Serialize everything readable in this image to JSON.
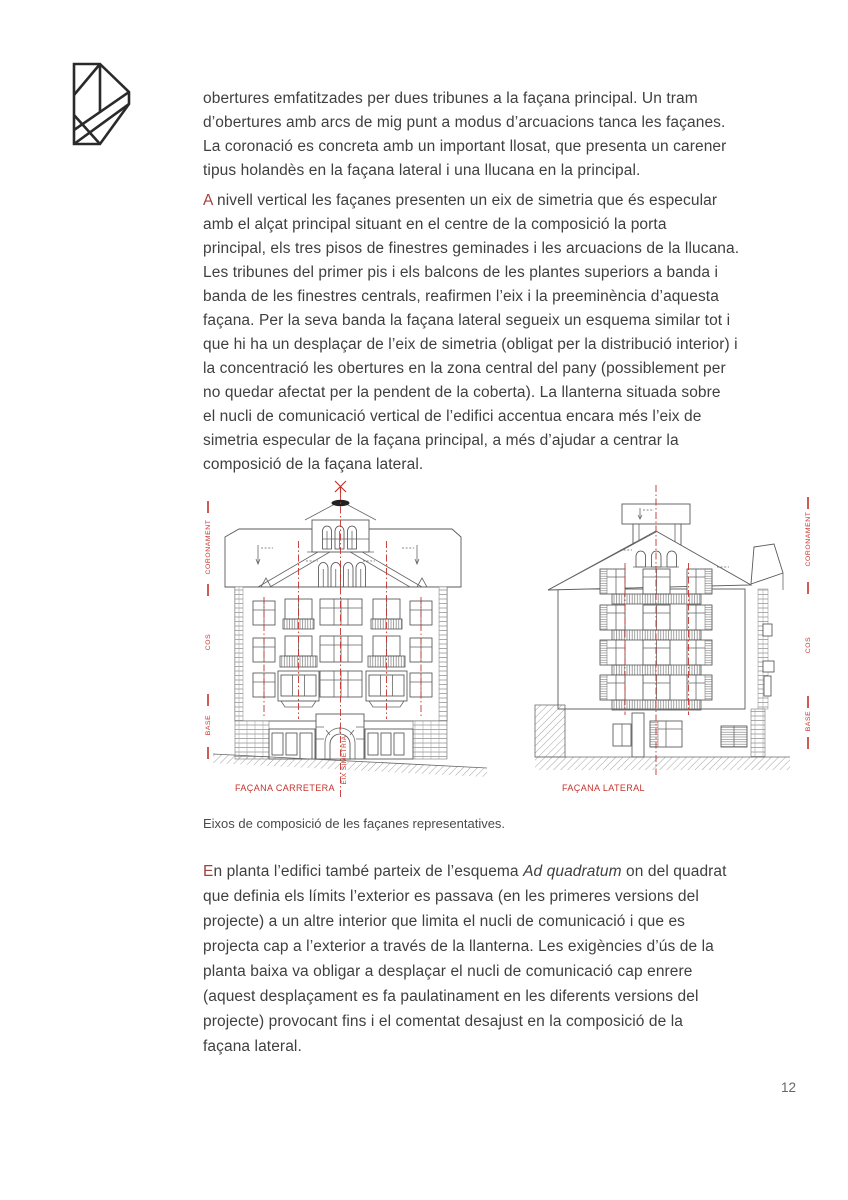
{
  "page": {
    "number": "12"
  },
  "logo": {
    "icon": "geometric-d-monogram"
  },
  "paragraphs": {
    "p1": "obertures emfatitzades per dues tribunes a la façana principal. Un tram\nd’obertures amb arcs de mig punt a modus d’arcuacions tanca les façanes.\nLa coronació es concreta amb un important llosat, que presenta un carener\ntipus holandès en la façana lateral i una llucana en la principal.",
    "p2_initial": "A",
    "p2_rest": " nivell vertical les façanes presenten un eix de simetria que és especular\namb el alçat principal situant en el centre de la composició la porta\nprincipal, els tres pisos de finestres geminades i les arcuacions de la llucana.\nLes tribunes del primer pis i els balcons de les plantes superiors a banda i\nbanda de les finestres centrals, reafirmen l’eix i la preeminència d’aquesta\nfaçana. Per la seva banda la façana lateral segueix un esquema similar tot i\nque hi ha un desplaçar de l’eix de simetria (obligat per la distribució interior) i\nla concentració les obertures en la zona central del pany (possiblement per\nno quedar afectat per la pendent de la coberta). La llanterna situada sobre\nel nucli de comunicació vertical de l’edifici accentua encara més l’eix de\nsimetria especular de la façana principal, a més d’ajudar a centrar la\ncomposició de la façana lateral.",
    "p3_initial": "E",
    "p3_pre_italic": "n planta l’edifici també parteix de l’esquema ",
    "p3_italic": "Ad quadratum",
    "p3_post_italic": " on del quadrat\nque definia els límits l’exterior es passava (en les primeres versions del\nprojecte) a un altre interior que limita el nucli de comunicació i que es\nprojecta cap a l’exterior a través de la llanterna. Les exigències d’ús de la\nplanta baixa va obligar a desplaçar el nucli de comunicació cap enrere\n(aquest desplaçament es fa paulatinament en les diferents versions del\nprojecte) provocant fins i el comentat desajust en la composició de la\nfaçana lateral."
  },
  "figure": {
    "caption": "Eixos de composició de les façanes representatives.",
    "left": {
      "title": "FAÇANA CARRETERA",
      "axis_label": "EIX SIMETRIA",
      "zones": [
        "CORONAMENT",
        "COS",
        "BASE"
      ]
    },
    "right": {
      "title": "FAÇANA LATERAL",
      "zones": [
        "CORONAMENT",
        "COS",
        "BASE"
      ]
    }
  },
  "colors": {
    "text": "#3f3f3f",
    "initial_red": "#9e423c",
    "annotation_red": "#c5332d"
  }
}
